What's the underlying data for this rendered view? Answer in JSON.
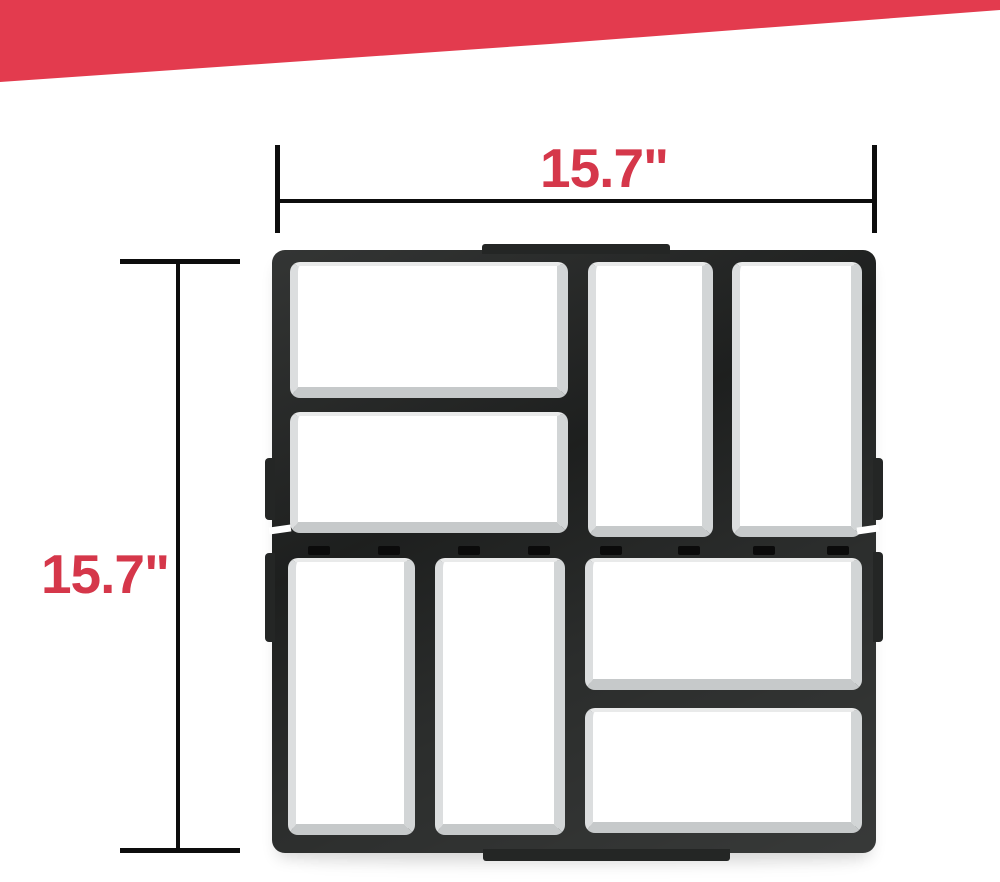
{
  "dimensions": {
    "width_label": "15.7\"",
    "height_label": "15.7\""
  },
  "colors": {
    "banner_red": "#E33B4E",
    "label_red": "#D5374A",
    "dimension_line": "#0D0D0D",
    "mold_frame": "#242625",
    "mold_cell": "#FFFFFF",
    "page_bg": "#FFFFFF"
  }
}
